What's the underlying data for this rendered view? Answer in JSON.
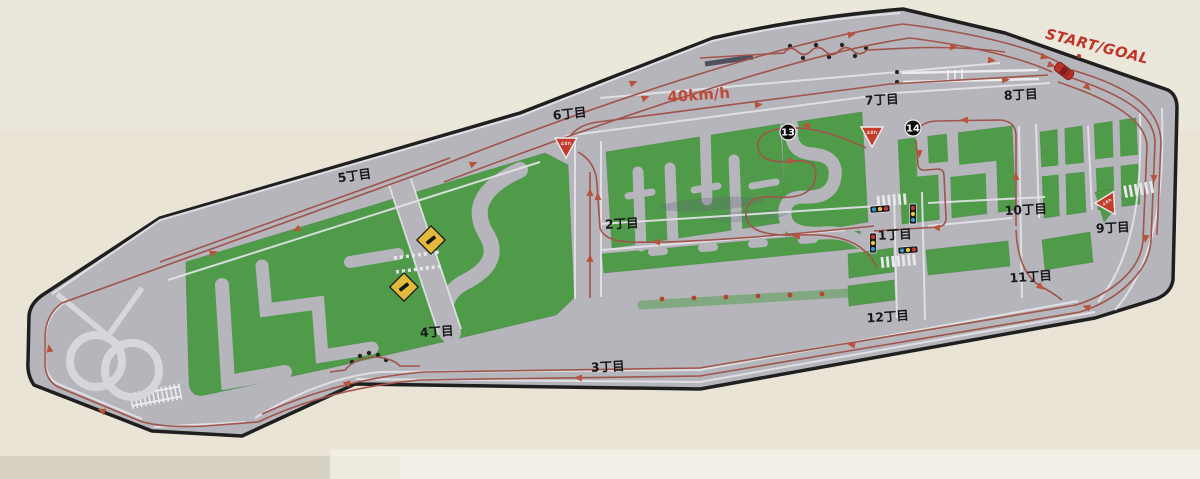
{
  "course": {
    "start_goal_label": "START/GOAL",
    "speed_label": "40km/h"
  },
  "districts": [
    {
      "label": "1丁目"
    },
    {
      "label": "2丁目"
    },
    {
      "label": "3丁目"
    },
    {
      "label": "4丁目"
    },
    {
      "label": "5丁目"
    },
    {
      "label": "6丁目"
    },
    {
      "label": "7丁目"
    },
    {
      "label": "8丁目"
    },
    {
      "label": "9丁目"
    },
    {
      "label": "10丁目"
    },
    {
      "label": "11丁目"
    },
    {
      "label": "12丁目"
    }
  ],
  "checkpoints": [
    {
      "label": "13"
    },
    {
      "label": "14"
    }
  ],
  "signs": {
    "stop_label": "止まれ"
  },
  "colors": {
    "paper": "#e9e4d6",
    "course_surface": "#b5b5bb",
    "grass_green": "#4f9b49",
    "route_red": "#a0544b",
    "accent_red": "#c13227",
    "sign_yellow": "#e2b93a",
    "lane_white": "#e3e3e8"
  }
}
